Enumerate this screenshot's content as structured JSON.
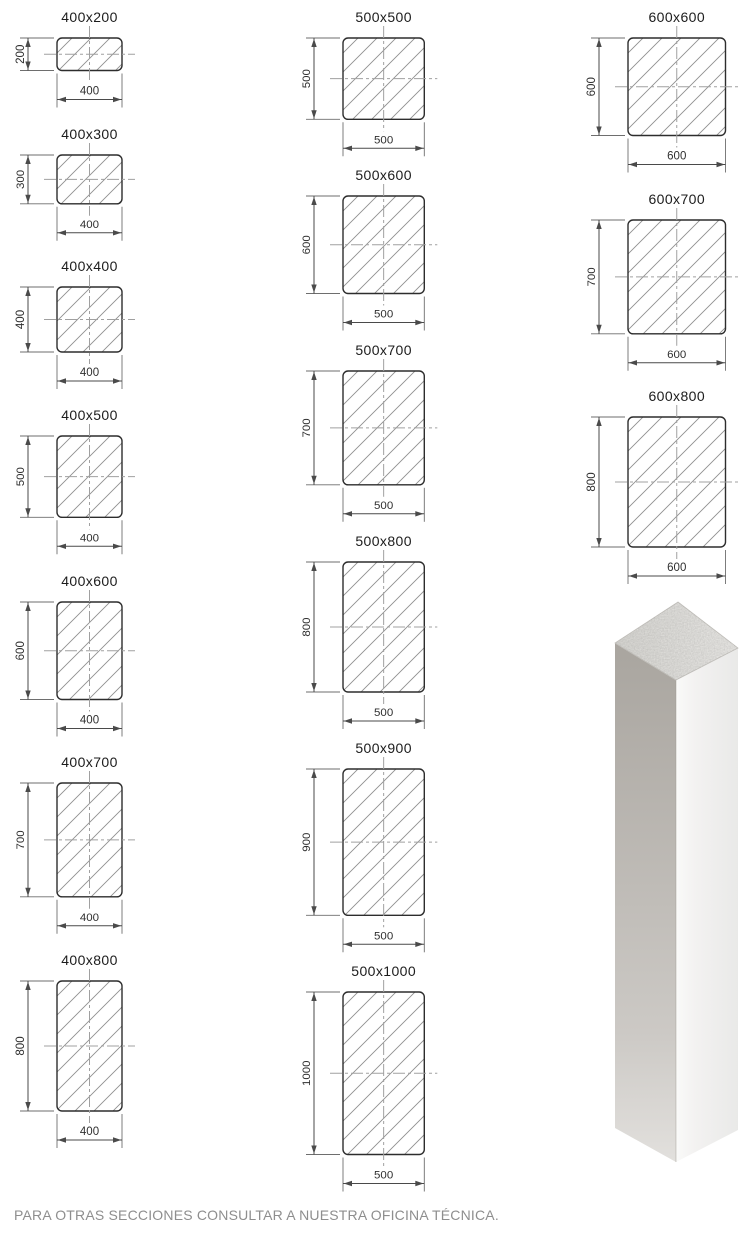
{
  "footer": {
    "note": "PARA OTRAS SECCIONES CONSULTAR A NUESTRA OFICINA TÉCNICA."
  },
  "colors": {
    "outline": "#2d2d2d",
    "hatch": "#8f8f8f",
    "centerline": "#a0a0a0",
    "extension_line": "#6e6e6e",
    "dimension_line": "#4a4a4a",
    "dimension_text": "#2f2f2f",
    "title_text": "#1c1c1c",
    "footer_text": "#8e8e8e",
    "column_left_face_top": "#a9a59f",
    "column_left_face_bottom": "#deDCd8",
    "column_right_face": "#f0efed",
    "column_top_face": "#e6e5e1"
  },
  "diagram": {
    "columns": [
      {
        "name": "400-series",
        "items": [
          {
            "label": "400x200",
            "w_mm": 400,
            "h_mm": 200,
            "w_label": "400",
            "h_label": "200"
          },
          {
            "label": "400x300",
            "w_mm": 400,
            "h_mm": 300,
            "w_label": "400",
            "h_label": "300"
          },
          {
            "label": "400x400",
            "w_mm": 400,
            "h_mm": 400,
            "w_label": "400",
            "h_label": "400"
          },
          {
            "label": "400x500",
            "w_mm": 400,
            "h_mm": 500,
            "w_label": "400",
            "h_label": "500"
          },
          {
            "label": "400x600",
            "w_mm": 400,
            "h_mm": 600,
            "w_label": "400",
            "h_label": "600"
          },
          {
            "label": "400x700",
            "w_mm": 400,
            "h_mm": 700,
            "w_label": "400",
            "h_label": "700"
          },
          {
            "label": "400x800",
            "w_mm": 400,
            "h_mm": 800,
            "w_label": "400",
            "h_label": "800"
          }
        ]
      },
      {
        "name": "500-series",
        "items": [
          {
            "label": "500x500",
            "w_mm": 500,
            "h_mm": 500,
            "w_label": "500",
            "h_label": "500"
          },
          {
            "label": "500x600",
            "w_mm": 500,
            "h_mm": 600,
            "w_label": "500",
            "h_label": "600"
          },
          {
            "label": "500x700",
            "w_mm": 500,
            "h_mm": 700,
            "w_label": "500",
            "h_label": "700"
          },
          {
            "label": "500x800",
            "w_mm": 500,
            "h_mm": 800,
            "w_label": "500",
            "h_label": "800"
          },
          {
            "label": "500x900",
            "w_mm": 500,
            "h_mm": 900,
            "w_label": "500",
            "h_label": "900"
          },
          {
            "label": "500x1000",
            "w_mm": 500,
            "h_mm": 1000,
            "w_label": "500",
            "h_label": "1000"
          }
        ]
      },
      {
        "name": "600-series",
        "items": [
          {
            "label": "600x600",
            "w_mm": 600,
            "h_mm": 600,
            "w_label": "600",
            "h_label": "600"
          },
          {
            "label": "600x700",
            "w_mm": 600,
            "h_mm": 700,
            "w_label": "600",
            "h_label": "700"
          },
          {
            "label": "600x800",
            "w_mm": 600,
            "h_mm": 800,
            "w_label": "600",
            "h_label": "800"
          }
        ]
      }
    ]
  }
}
